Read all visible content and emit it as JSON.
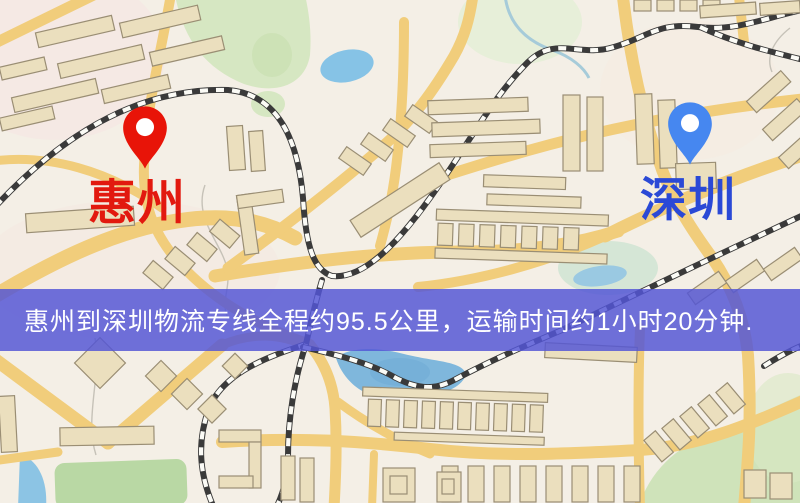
{
  "map": {
    "markers": [
      {
        "id": "origin",
        "label": "惠州",
        "pin_color": "#e81408",
        "label_color": "#e2190f"
      },
      {
        "id": "destination",
        "label": "深圳",
        "pin_color": "#4687f0",
        "label_color": "#2a49d6"
      }
    ],
    "palette": {
      "background": "#f4efe6",
      "road": "#f1cd7b",
      "building_fill": "#ebdfbe",
      "building_stroke": "#9a8e74",
      "railway": "#3a3a3a",
      "park_green": "#d6e7c2",
      "water_blue": "#86c3e6"
    }
  },
  "banner": {
    "text": "惠州到深圳物流专线全程约95.5公里，运输时间约1小时20分钟.",
    "background": "#5456d5",
    "text_color": "#ffffff"
  },
  "route": {
    "origin": "惠州",
    "destination": "深圳",
    "distance": "约95.5公里",
    "duration": "约1小时20分钟"
  }
}
